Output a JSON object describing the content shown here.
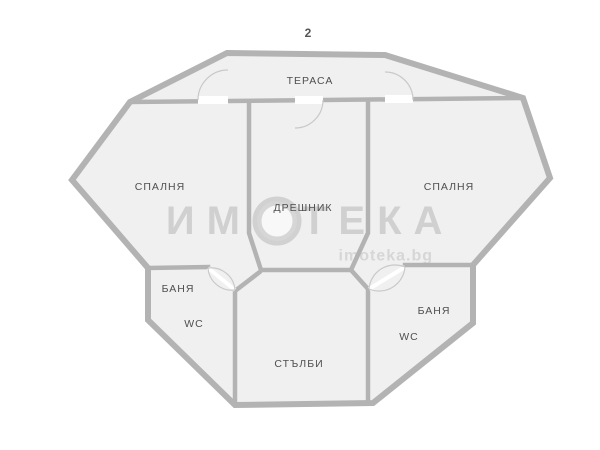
{
  "page": {
    "floor_number": "2"
  },
  "rooms": {
    "terrace": "ТЕРАСА",
    "bedroom_left": "СПАЛНЯ",
    "bedroom_right": "СПАЛНЯ",
    "closet": "ДРЕШНИК",
    "bath_left": "БАНЯ",
    "wc_left": "WC",
    "bath_right": "БАНЯ",
    "wc_right": "WC",
    "stairs": "СТЪЛБИ"
  },
  "watermark": {
    "brand_start": "ИМ",
    "brand_end": "ТЕКА",
    "website": "imoteka.bg"
  },
  "colors": {
    "wall": "#b3b3b3",
    "floor": "#f0f0f0",
    "label": "#4f4f4f",
    "door_arc": "#c9c9c9"
  }
}
